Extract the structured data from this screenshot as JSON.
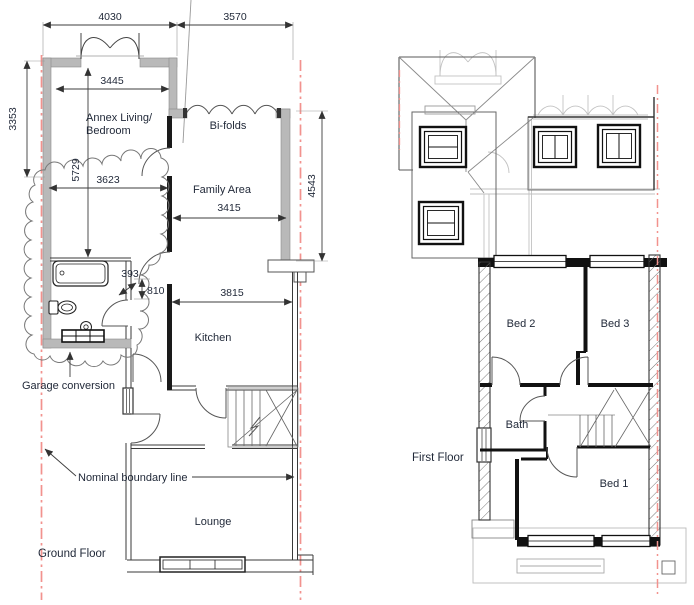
{
  "ground_floor": {
    "label": "Ground Floor",
    "rooms": {
      "annex_line1": "Annex Living/",
      "annex_line2": "Bedroom",
      "bifolds": "Bi-folds",
      "family": "Family Area",
      "kitchen": "Kitchen",
      "lounge": "Lounge"
    },
    "dimensions": {
      "top_left": "4030",
      "top_right": "3570",
      "annex_inner_width": "3445",
      "annex_height": "3353",
      "annex_length": "5729",
      "annex_lower_width": "3623",
      "family_width": "3415",
      "family_height": "4543",
      "gap": "393",
      "offset": "810",
      "kitchen_width": "3815"
    },
    "annotations": {
      "garage": "Garage conversion",
      "boundary": "Nominal boundary line"
    }
  },
  "first_floor": {
    "label": "First Floor",
    "rooms": {
      "bed2": "Bed 2",
      "bed3": "Bed 3",
      "bath": "Bath",
      "bed1": "Bed 1"
    }
  },
  "colors": {
    "boundary_line": "#f2928e",
    "wall_fill": "#b9b9b9",
    "ink": "#1f2737"
  }
}
